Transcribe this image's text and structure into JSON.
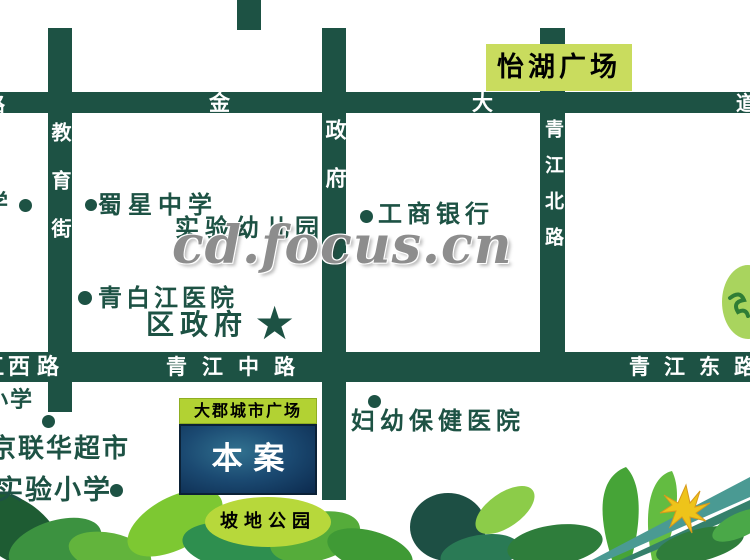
{
  "watermark": "cd.focus.cn",
  "colors": {
    "road_green": "#1d5244",
    "poi_text_green": "#1d5244",
    "sign_yellow_green": "#c9dc5e",
    "project_label_green": "#b2d233",
    "site_box_blue": "#1b4a72",
    "park_green": "#b7d83b",
    "watermark_gray": "#8d8d8d",
    "flower_yellow": "#eec41a"
  },
  "road_labels": {
    "top_left_partial": "路",
    "top_char_1": "金",
    "top_char_2": "大",
    "top_right_partial": "道",
    "left_vertical": "教育街",
    "center_vertical": "政府",
    "right_vertical": "青江北路",
    "mid_west_partial": "江",
    "mid_west": "西路",
    "mid_center": "青江中路",
    "mid_east": "青江东路"
  },
  "pois": {
    "edge_school_partial": "学",
    "shuxing_middle_school": "蜀星中学",
    "experimental_kindergarten": "实验幼儿园",
    "icbc_bank": "工商银行",
    "qingbaijiang_hospital": "青白江医院",
    "district_government": "区政府",
    "government_star": "★",
    "mch_hospital": "妇幼保健医院",
    "bottom_school_partial": "小学",
    "lianhua_supermarket": "京联华超市",
    "experimental_primary_school": "实验小学"
  },
  "places": {
    "yihu_square": "怡湖广场",
    "project_name": "大郡城市广场",
    "site_label": "本 案",
    "park": "坡地公园"
  }
}
